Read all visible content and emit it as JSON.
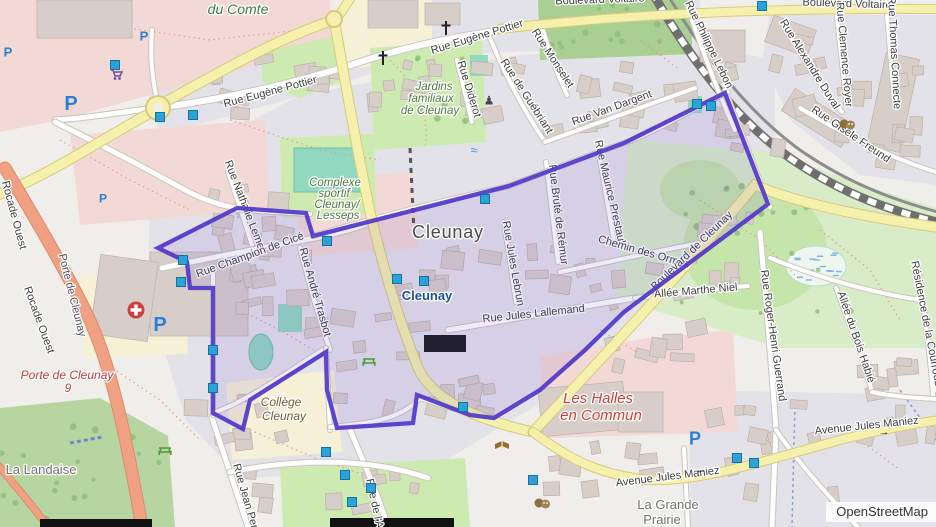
{
  "map": {
    "attribution": "OpenStreetMap",
    "colors": {
      "boundary_stroke": "#5238c9",
      "boundary_fill": "rgba(91,68,204,0.11)",
      "marker_fill": "#2ba2d8",
      "marker_stroke": "#13719f",
      "road_yellow": "#f5f1ac",
      "motorway_orange": "#f0a184",
      "residential": "#e4e2e9",
      "grass": "#cdebb0",
      "retail_pink": "#f3d9d5"
    },
    "boundary": {
      "name": "Cleunay quarter boundary",
      "points": [
        [
          158,
          248
        ],
        [
          237,
          208
        ],
        [
          306,
          213
        ],
        [
          313,
          236
        ],
        [
          509,
          186
        ],
        [
          624,
          143
        ],
        [
          725,
          93
        ],
        [
          768,
          204
        ],
        [
          624,
          312
        ],
        [
          585,
          350
        ],
        [
          540,
          390
        ],
        [
          494,
          418
        ],
        [
          470,
          415
        ],
        [
          417,
          395
        ],
        [
          413,
          423
        ],
        [
          337,
          428
        ],
        [
          327,
          390
        ],
        [
          326,
          352
        ],
        [
          250,
          400
        ],
        [
          243,
          429
        ],
        [
          213,
          413
        ],
        [
          213,
          288
        ],
        [
          190,
          288
        ],
        [
          187,
          262
        ]
      ]
    },
    "markers": [
      [
        115,
        65
      ],
      [
        160,
        117
      ],
      [
        193,
        115
      ],
      [
        762,
        6
      ],
      [
        697,
        104
      ],
      [
        711,
        106
      ],
      [
        327,
        241
      ],
      [
        485,
        199
      ],
      [
        397,
        279
      ],
      [
        424,
        281
      ],
      [
        183,
        260
      ],
      [
        181,
        282
      ],
      [
        213,
        350
      ],
      [
        213,
        388
      ],
      [
        326,
        452
      ],
      [
        345,
        475
      ],
      [
        371,
        488
      ],
      [
        352,
        502
      ],
      [
        463,
        407
      ],
      [
        533,
        480
      ],
      [
        737,
        458
      ],
      [
        754,
        463
      ]
    ],
    "street_labels": [
      {
        "text": "Boulevard Voltaire",
        "x": 847,
        "y": 7,
        "r": 2,
        "cls": "road"
      },
      {
        "text": "Boulevard Voltaire",
        "x": 600,
        "y": 3,
        "r": -2,
        "cls": "road"
      },
      {
        "text": "Rue Philippe Lebon",
        "x": 706,
        "y": 46,
        "r": 64,
        "cls": "road"
      },
      {
        "text": "Rue Alexandre Duval",
        "x": 807,
        "y": 66,
        "r": 58,
        "cls": "road"
      },
      {
        "text": "Rue Clemence Royer",
        "x": 841,
        "y": 55,
        "r": 85,
        "cls": "road"
      },
      {
        "text": "Rue Thomas Connecte",
        "x": 891,
        "y": 53,
        "r": 87,
        "cls": "road"
      },
      {
        "text": "Rue Gisèle Freund",
        "x": 849,
        "y": 137,
        "r": 34,
        "cls": "road"
      },
      {
        "text": "Rue Monselet",
        "x": 550,
        "y": 60,
        "r": 57,
        "cls": "road"
      },
      {
        "text": "Rue de Guébriant",
        "x": 524,
        "y": 98,
        "r": 57,
        "cls": "road"
      },
      {
        "text": "Rue Diderot",
        "x": 466,
        "y": 90,
        "r": 73,
        "cls": "road"
      },
      {
        "text": "Rue Van Dargent",
        "x": 613,
        "y": 111,
        "r": -20,
        "cls": "road"
      },
      {
        "text": "Rue Eugène Pottier",
        "x": 271,
        "y": 95,
        "r": -15,
        "cls": "road"
      },
      {
        "text": "Rue Eugène Pottier",
        "x": 478,
        "y": 40,
        "r": -17,
        "cls": "road"
      },
      {
        "text": "Rue Nathalie Lemel",
        "x": 242,
        "y": 207,
        "r": 69,
        "cls": "road"
      },
      {
        "text": "Rue Champion de Cicé",
        "x": 251,
        "y": 258,
        "r": -20,
        "cls": "road"
      },
      {
        "text": "Rue André Trasbot",
        "x": 312,
        "y": 293,
        "r": 74,
        "cls": "road"
      },
      {
        "text": "Rue Jules Lebrun",
        "x": 510,
        "y": 264,
        "r": 80,
        "cls": "road"
      },
      {
        "text": "Rue Bruté de Rémur",
        "x": 555,
        "y": 215,
        "r": 83,
        "cls": "road"
      },
      {
        "text": "Rue Maurice Prestault",
        "x": 607,
        "y": 194,
        "r": 77,
        "cls": "road"
      },
      {
        "text": "Chemin des Ormes",
        "x": 643,
        "y": 255,
        "r": 16,
        "cls": "road"
      },
      {
        "text": "Rue Jules Lallemand",
        "x": 534,
        "y": 317,
        "r": -6,
        "cls": "road"
      },
      {
        "text": "Allée Marthe Niel",
        "x": 696,
        "y": 294,
        "r": -5,
        "cls": "road"
      },
      {
        "text": "Rue Roger-Henri Guerrand",
        "x": 770,
        "y": 336,
        "r": 82,
        "cls": "road"
      },
      {
        "text": "Allée du Bois Habié",
        "x": 853,
        "y": 338,
        "r": 71,
        "cls": "road"
      },
      {
        "text": "Résidence de la Courrouze",
        "x": 924,
        "y": 327,
        "r": 79,
        "cls": "road"
      },
      {
        "text": "Boulevard de Cleunay",
        "x": 694,
        "y": 253,
        "r": -44,
        "cls": "road"
      },
      {
        "text": "Rocade Ouest",
        "x": 11,
        "y": 216,
        "r": 75,
        "cls": "road"
      },
      {
        "text": "Rocade Ouest",
        "x": 36,
        "y": 321,
        "r": 70,
        "cls": "road"
      },
      {
        "text": "Porte de Cleunay",
        "x": 69,
        "y": 296,
        "r": 76,
        "cls": "ramp"
      },
      {
        "text": "Avenue Jules Maniez",
        "x": 668,
        "y": 480,
        "r": -7,
        "cls": "road"
      },
      {
        "text": "Avenue Jules Maniez",
        "x": 867,
        "y": 429,
        "r": -6,
        "cls": "road"
      },
      {
        "text": "Rue Jean Perrin",
        "x": 244,
        "y": 503,
        "r": 74,
        "cls": "road"
      },
      {
        "text": "Rue de l'Aff",
        "x": 372,
        "y": 507,
        "r": 78,
        "cls": "road"
      }
    ],
    "place_labels": [
      {
        "text": "du Comte",
        "x": 238,
        "y": 14,
        "r": 0,
        "cls": "park-lg"
      },
      {
        "text": "Jardins",
        "x": 434,
        "y": 90,
        "r": 0,
        "cls": "park"
      },
      {
        "text": "familiaux",
        "x": 431,
        "y": 102,
        "r": 0,
        "cls": "park"
      },
      {
        "text": "de Cleunay",
        "x": 430,
        "y": 114,
        "r": 0,
        "cls": "park"
      },
      {
        "text": "Complexe",
        "x": 335,
        "y": 186,
        "r": 0,
        "cls": "park"
      },
      {
        "text": "sportif",
        "x": 334,
        "y": 197,
        "r": 0,
        "cls": "park"
      },
      {
        "text": "Cleunay/",
        "x": 337,
        "y": 208,
        "r": 0,
        "cls": "park"
      },
      {
        "text": "Lesseps",
        "x": 338,
        "y": 219,
        "r": 0,
        "cls": "park"
      },
      {
        "text": "Cleunay",
        "x": 448,
        "y": 238,
        "r": 0,
        "cls": "city"
      },
      {
        "text": "Cleunay",
        "x": 427,
        "y": 300,
        "r": 0,
        "cls": "station"
      },
      {
        "text": "La Landaise",
        "x": 41,
        "y": 474,
        "r": 0,
        "cls": "locality"
      },
      {
        "text": "Collège",
        "x": 281,
        "y": 406,
        "r": 0,
        "cls": "school"
      },
      {
        "text": "Cleunay",
        "x": 284,
        "y": 420,
        "r": 0,
        "cls": "school"
      },
      {
        "text": "Les Halles",
        "x": 598,
        "y": 403,
        "r": 0,
        "cls": "halles"
      },
      {
        "text": "en Commun",
        "x": 601,
        "y": 420,
        "r": 0,
        "cls": "halles"
      },
      {
        "text": "Porte de Cleunay",
        "x": 67,
        "y": 379,
        "r": 0,
        "cls": "exit"
      },
      {
        "text": "9",
        "x": 68,
        "y": 392,
        "r": 0,
        "cls": "exit"
      },
      {
        "text": "La Grande",
        "x": 668,
        "y": 509,
        "r": 0,
        "cls": "locality"
      },
      {
        "text": "Prairie",
        "x": 662,
        "y": 524,
        "r": 0,
        "cls": "locality"
      }
    ],
    "icons": [
      {
        "type": "parking",
        "x": 8,
        "y": 52,
        "s": 13
      },
      {
        "type": "parking",
        "x": 144,
        "y": 36,
        "s": 13
      },
      {
        "type": "parking",
        "x": 71,
        "y": 103,
        "s": 20
      },
      {
        "type": "parking",
        "x": 103,
        "y": 198,
        "s": 12
      },
      {
        "type": "parking",
        "x": 160,
        "y": 324,
        "s": 20
      },
      {
        "type": "parking",
        "x": 695,
        "y": 438,
        "s": 18
      },
      {
        "type": "hospital",
        "x": 136,
        "y": 310
      },
      {
        "type": "church",
        "x": 383,
        "y": 58
      },
      {
        "type": "church",
        "x": 446,
        "y": 28
      },
      {
        "type": "monument",
        "x": 489,
        "y": 100
      },
      {
        "type": "shopping-cart",
        "x": 116,
        "y": 74
      },
      {
        "type": "library-book",
        "x": 502,
        "y": 445
      },
      {
        "type": "theater",
        "x": 847,
        "y": 124
      },
      {
        "type": "theater",
        "x": 542,
        "y": 503
      },
      {
        "type": "picnic",
        "x": 369,
        "y": 361
      },
      {
        "type": "picnic",
        "x": 165,
        "y": 450
      },
      {
        "type": "fountain",
        "x": 474,
        "y": 150
      },
      {
        "type": "arrow-left",
        "x": 701,
        "y": 469
      },
      {
        "type": "arrow-right",
        "x": 884,
        "y": 431
      }
    ]
  }
}
